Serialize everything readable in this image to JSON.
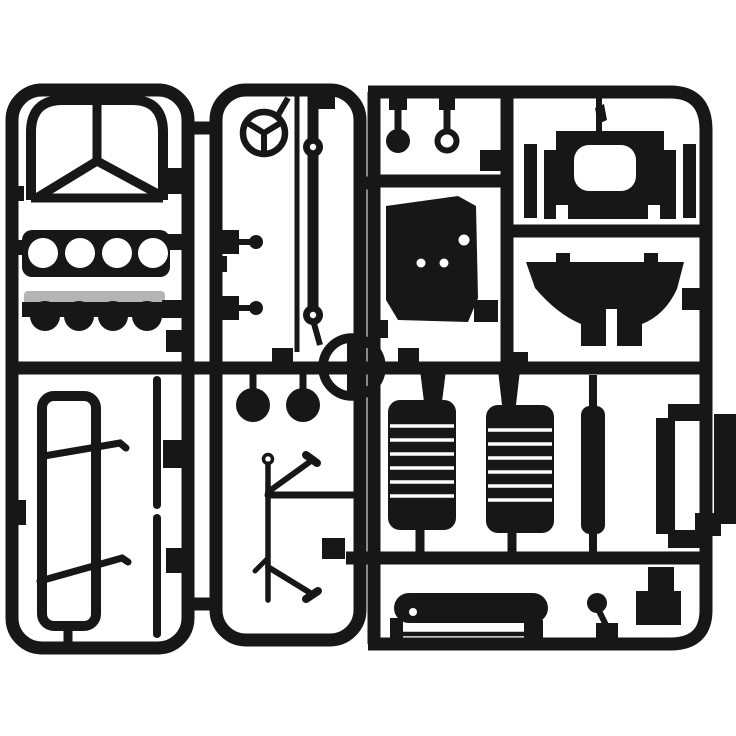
{
  "image": {
    "description": "Black injection-moulded plastic model-kit sprue (parts tree) for a truck model photographed on a white background. The runner frame holds a cab windshield frame, a front panel with four round holes, a gray-topped fender strip, a window frame with linkage rods, a Mercedes star emblem, a drive shaft with ball joints, a steering wheel, two brake-drum discs, wiper arms, round pins, an engine block, a cab back panel with window opening, a seat base, two ribbed radiator/seat panels, thin bars, a door frame, a bumper bar, a gear knob and small plates."
  },
  "colors": {
    "plastic": "#171717",
    "background": "#ffffff",
    "gray-part": "#b4b4b4"
  },
  "parts": [
    {
      "name": "sprue-runners",
      "label": "runner frame"
    },
    {
      "name": "part-cab-windshield-frame",
      "label": "cab windshield frame"
    },
    {
      "name": "part-front-panel-four-holes",
      "label": "front panel with four holes"
    },
    {
      "name": "part-fender-strip",
      "label": "fender strip with gray top"
    },
    {
      "name": "part-window-frame",
      "label": "window frame"
    },
    {
      "name": "part-linkage-rods",
      "label": "linkage rods"
    },
    {
      "name": "part-thin-rod-left",
      "label": "thin rod"
    },
    {
      "name": "part-mercedes-star",
      "label": "Mercedes star emblem"
    },
    {
      "name": "part-small-pegs",
      "label": "small pegs"
    },
    {
      "name": "part-antenna-rod",
      "label": "antenna rod"
    },
    {
      "name": "part-drive-shaft",
      "label": "drive shaft with ball joints"
    },
    {
      "name": "part-steering-wheel",
      "label": "steering wheel"
    },
    {
      "name": "part-brake-drums",
      "label": "brake drum discs"
    },
    {
      "name": "part-wiper-arms",
      "label": "wiper arms"
    },
    {
      "name": "part-round-pins",
      "label": "round pins"
    },
    {
      "name": "part-engine-block",
      "label": "engine block"
    },
    {
      "name": "part-cab-back-panel",
      "label": "cab back panel"
    },
    {
      "name": "part-seat-base",
      "label": "seat base"
    },
    {
      "name": "part-radiator-grille-1",
      "label": "ribbed panel 1"
    },
    {
      "name": "part-radiator-grille-2",
      "label": "ribbed panel 2"
    },
    {
      "name": "part-thin-bar",
      "label": "thin bar"
    },
    {
      "name": "part-door-frame",
      "label": "door frame"
    },
    {
      "name": "part-side-bar-outer",
      "label": "outer side bar"
    },
    {
      "name": "part-bumper-bar",
      "label": "bumper bar"
    },
    {
      "name": "part-gear-knob",
      "label": "gear knob"
    },
    {
      "name": "part-small-plate",
      "label": "small plate"
    }
  ]
}
